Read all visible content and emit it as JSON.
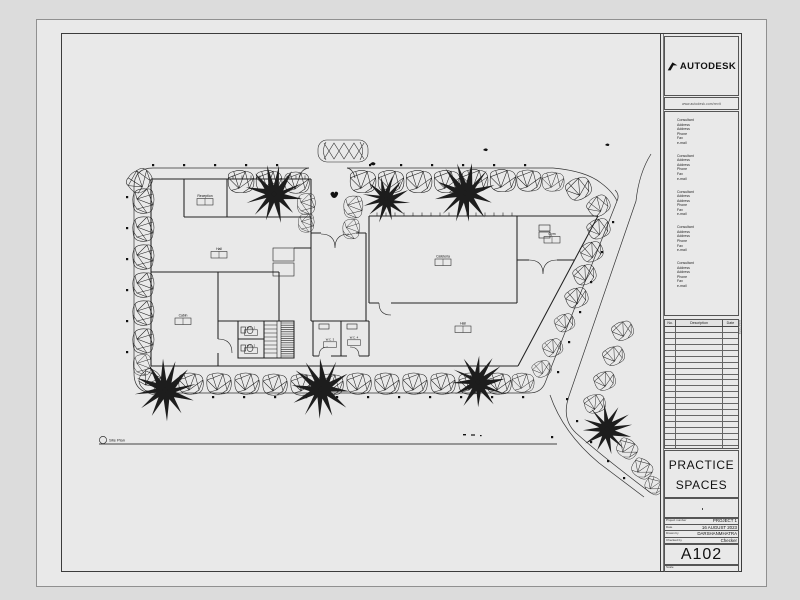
{
  "titleblock": {
    "brand": "AUTODESK",
    "website": "www.autodesk.com/revit",
    "consultant_lines": [
      "Consultant",
      "Address",
      "Address",
      "Phone",
      "Fax",
      "e-mail"
    ],
    "consultant_blocks": 5,
    "revision_table": {
      "headers": [
        "No.",
        "Description",
        "Date"
      ],
      "empty_rows": 24
    },
    "project_title": [
      "PRACTICE",
      "SPACES"
    ],
    "fields": [
      {
        "label": "Project number",
        "value": "PROJECT 1"
      },
      {
        "label": "Date",
        "value": "16 AUGUST 2023"
      },
      {
        "label": "Drawn by",
        "value": "DARSHANMHATRA"
      },
      {
        "label": "Checked by",
        "value": "Checker"
      }
    ],
    "sheet_number": "A102",
    "scale_label": "Scale",
    "plot_stamp": "8/16/2023"
  },
  "plan": {
    "view_title": "Site Plan",
    "rooms": {
      "reception": "Reception",
      "hall_left": "Hall",
      "cabin": "Cabin",
      "cafeteria": "Cafeteria",
      "gym": "Gym",
      "hall_right": "Hall",
      "wc1": "W.C. 1",
      "wc2": "W.C. 2",
      "wc3": "W.C. 3",
      "wc4": "W.C. 4"
    }
  },
  "colors": {
    "paper": "#e9e9e9",
    "background": "#dcdcdc",
    "ink": "#1c1c1c"
  }
}
